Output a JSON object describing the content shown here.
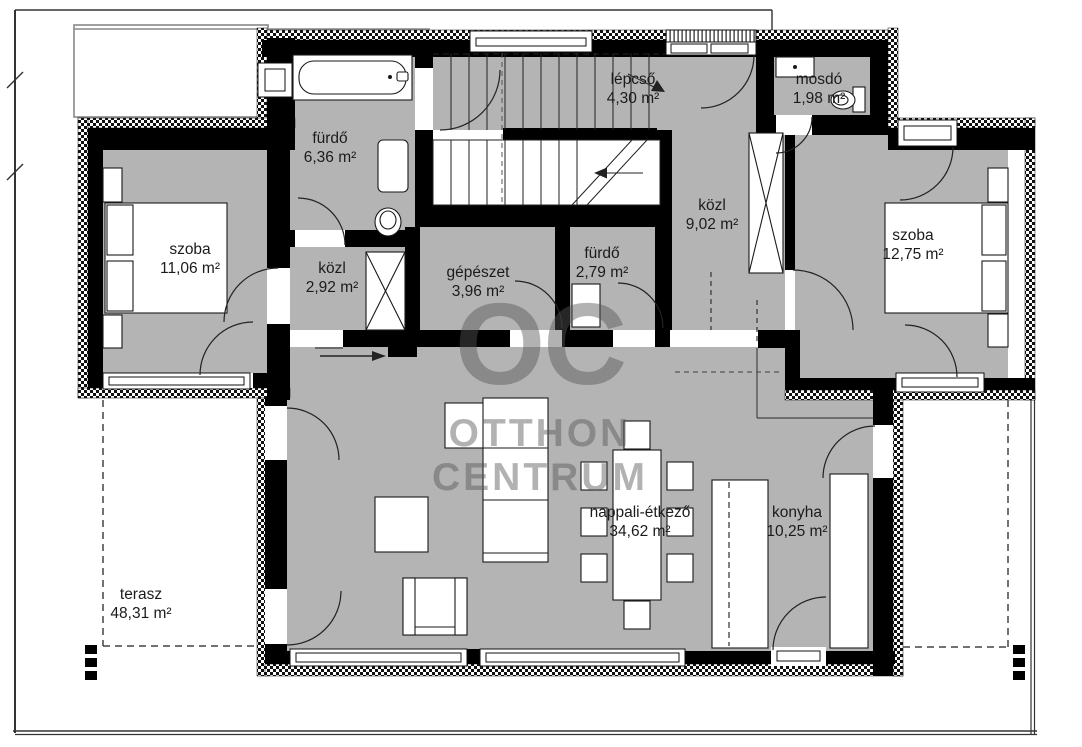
{
  "watermark": {
    "logo": "OC",
    "line1": "OTTHON",
    "line2": "CENTRUM"
  },
  "rooms": [
    {
      "id": "szoba-1",
      "name": "szoba",
      "area": "11,06 m²",
      "x": 190,
      "y": 240
    },
    {
      "id": "furdo-1",
      "name": "fürdő",
      "area": "6,36 m²",
      "x": 330,
      "y": 129
    },
    {
      "id": "kozl-1",
      "name": "közl",
      "area": "2,92 m²",
      "x": 332,
      "y": 259
    },
    {
      "id": "gepeszet",
      "name": "gépészet",
      "area": "3,96 m²",
      "x": 478,
      "y": 263
    },
    {
      "id": "furdo-2",
      "name": "fürdő",
      "area": "2,79 m²",
      "x": 602,
      "y": 244
    },
    {
      "id": "lepcso",
      "name": "lépcső",
      "area": "4,30 m²",
      "x": 633,
      "y": 70
    },
    {
      "id": "mosdo",
      "name": "mosdó",
      "area": "1,98 m²",
      "x": 819,
      "y": 70
    },
    {
      "id": "kozl-2",
      "name": "közl",
      "area": "9,02 m²",
      "x": 712,
      "y": 196
    },
    {
      "id": "szoba-2",
      "name": "szoba",
      "area": "12,75 m²",
      "x": 913,
      "y": 226
    },
    {
      "id": "nappali-etkezo",
      "name": "nappali-étkező",
      "area": "34,62 m²",
      "x": 640,
      "y": 503
    },
    {
      "id": "konyha",
      "name": "konyha",
      "area": "10,25 m²",
      "x": 797,
      "y": 503
    },
    {
      "id": "terasz",
      "name": "terasz",
      "area": "48,31 m²",
      "x": 141,
      "y": 585
    }
  ],
  "colors": {
    "floor": "#b4b4b4",
    "wall": "#000000",
    "watermark_gray": "#8d8d8d"
  }
}
